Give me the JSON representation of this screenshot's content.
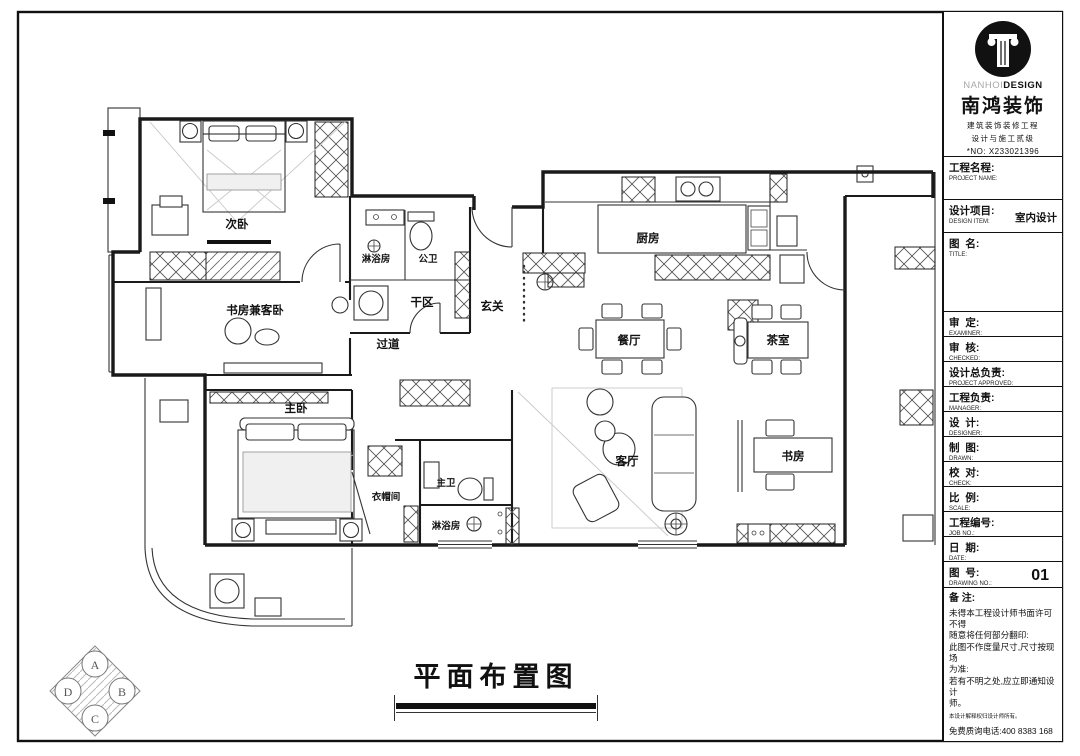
{
  "drawing": {
    "title": "平面布置图"
  },
  "rooms": {
    "ciwo": "次卧",
    "shufang_kewo": "书房兼客卧",
    "linyufang_top": "淋浴房",
    "gongwei": "公卫",
    "ganqu": "干区",
    "xuanguan": "玄关",
    "guodao": "过道",
    "chufang": "厨房",
    "canting": "餐厅",
    "chashi": "茶室",
    "keting": "客厅",
    "shufang": "书房",
    "zhuwo": "主卧",
    "yimaojian": "衣帽间",
    "zhuwei": "主卫",
    "linyufang_bottom": "淋浴房"
  },
  "elevation_marker": {
    "top": "A",
    "right": "B",
    "bottom": "C",
    "left": "D"
  },
  "title_block": {
    "brand": {
      "latin_light": "NANHOI",
      "latin_bold": "DESIGN",
      "company": "南鸿装饰",
      "line1": "建筑装饰装修工程",
      "line2": "设计与施工贰级",
      "license": "*NO: X233021396"
    },
    "design_item_value": "室内设计",
    "drawing_no_value": "01",
    "fields": [
      {
        "zh": "工程名程:",
        "en": "PROJECT NAME:"
      },
      {
        "zh": "设计项目:",
        "en": "DESIGN ITEM:"
      },
      {
        "zh": "图  名:",
        "en": "TITLE:"
      },
      {
        "zh": "审  定:",
        "en": "EXAMINER:"
      },
      {
        "zh": "审  核:",
        "en": "CHECKED:"
      },
      {
        "zh": "设计总负责:",
        "en": "PROJECT APPROVED:"
      },
      {
        "zh": "工程负责:",
        "en": "MANAGER:"
      },
      {
        "zh": "设  计:",
        "en": "DESIGNER:"
      },
      {
        "zh": "制  图:",
        "en": "DRAWN:"
      },
      {
        "zh": "校  对:",
        "en": "CHECK:"
      },
      {
        "zh": "比  例:",
        "en": "SCALE:"
      },
      {
        "zh": "工程编号:",
        "en": "JOB NO.:"
      },
      {
        "zh": "日  期:",
        "en": "DATE:"
      },
      {
        "zh": "图  号:",
        "en": "DRAWING NO.:"
      }
    ],
    "remarks_title": "备 注:",
    "remarks": [
      "未得本工程设计师书面许可不得",
      "随意将任何部分翻印:",
      "此图不作度量尺寸,尺寸按现场",
      "为准:",
      "若有不明之处,应立即通知设计",
      "师。"
    ],
    "remarks_small": "本设计解释权归设计师所有。",
    "hotline": "免费质询电话:400 8383 168"
  }
}
